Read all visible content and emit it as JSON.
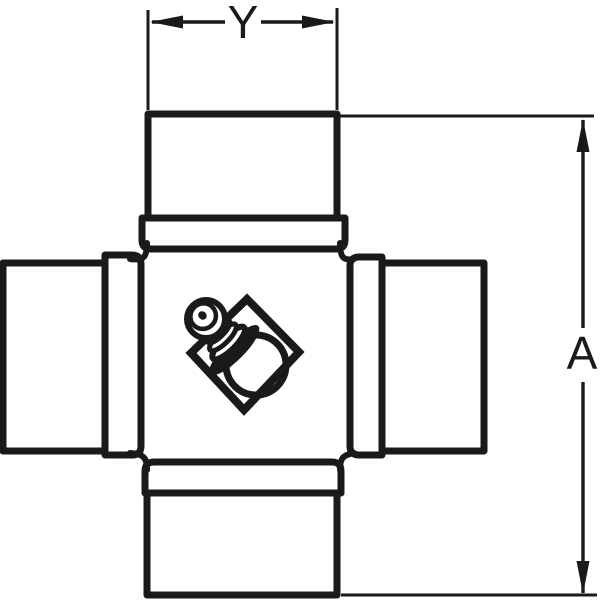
{
  "colors": {
    "line": "#1a1a1a",
    "background": "#ffffff"
  },
  "diagram": {
    "dimensions": {
      "width": {
        "label": "Y"
      },
      "height": {
        "label": "A"
      }
    }
  }
}
